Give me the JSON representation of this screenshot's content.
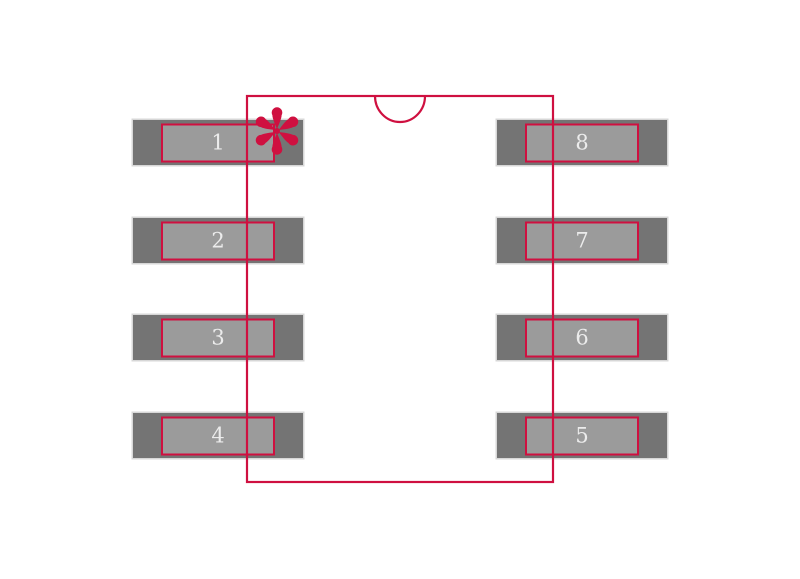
{
  "diagram": {
    "pins": {
      "left": [
        "1",
        "2",
        "3",
        "4"
      ],
      "right": [
        "8",
        "7",
        "6",
        "5"
      ]
    },
    "pin1_marker": "asterisk-icon",
    "colors": {
      "outline": "#cf1040",
      "pad_outer": "#747474",
      "pad_inner": "#9b9b9b",
      "pad_edge": "#d7d7d7",
      "pad_number": "#ececec",
      "background": "#ffffff"
    }
  }
}
